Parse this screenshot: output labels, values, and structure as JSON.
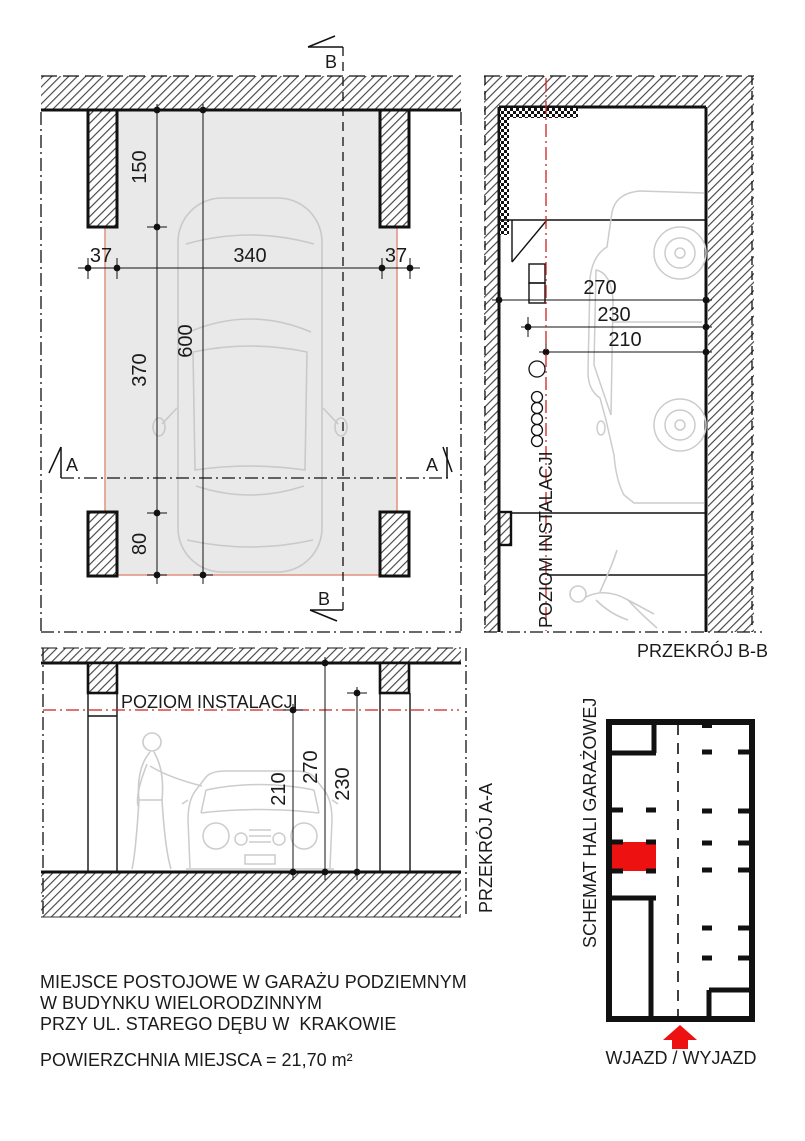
{
  "drawing": {
    "plan": {
      "marker_b": "B",
      "marker_a": "A",
      "dim_150": "150",
      "dim_37_left": "37",
      "dim_340": "340",
      "dim_37_right": "37",
      "dim_370": "370",
      "dim_600": "600",
      "dim_80": "80"
    },
    "section_bb": {
      "title": "PRZEKRÓJ B-B",
      "install_level_label": "POZIOM INSTALACJI",
      "dim_270": "270",
      "dim_230": "230",
      "dim_210": "210"
    },
    "section_aa": {
      "title": "PRZEKRÓJ A-A",
      "install_level_label": "POZIOM INSTALACJI",
      "dim_210": "210",
      "dim_270": "270",
      "dim_230": "230"
    },
    "schematic": {
      "title": "SCHEMAT HALI GARAŻOWEJ",
      "entry_label": "WJAZD / WYJAZD"
    },
    "notes": {
      "line1": "MIEJSCE POSTOJOWE W GARAŻU PODZIEMNYM",
      "line2": "W BUDYNKU WIELORODZINNYM",
      "line3": "PRZY UL. STAREGO DĘBU W  KRAKOWIE",
      "area": "POWIERZCHNIA MIEJSCA = 21,70 m²"
    },
    "colors": {
      "highlight_red": "#ee1111",
      "install_line_red": "#cc2222",
      "parking_outline_red": "#e2917f",
      "parking_fill_gray": "#e9e9e9"
    }
  }
}
